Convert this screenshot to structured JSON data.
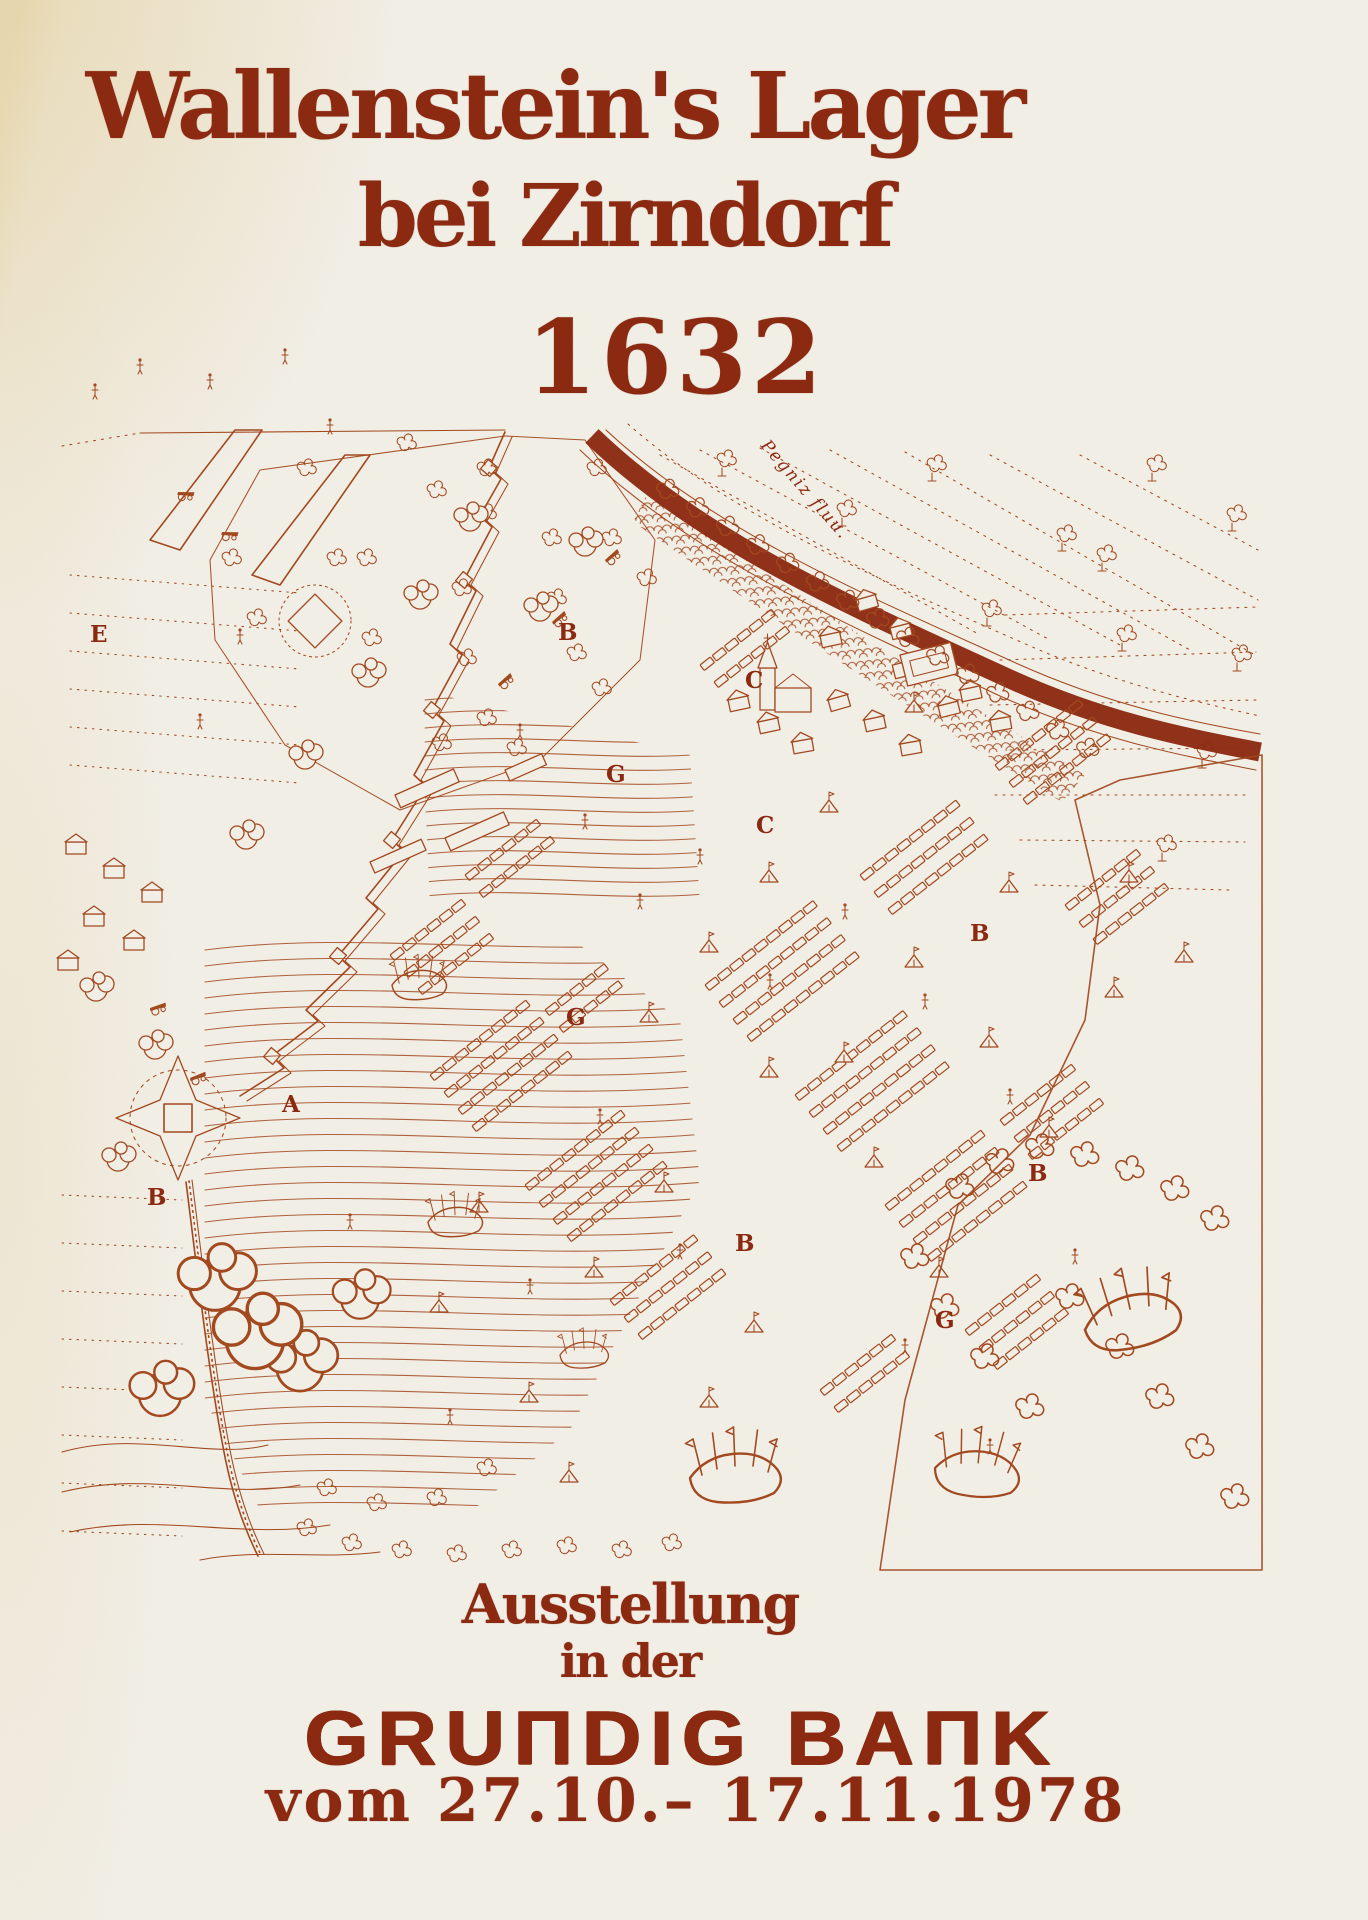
{
  "poster": {
    "title_line1": "Wallenstein's Lager",
    "title_line2": "bei Zirndorf",
    "year": "1632",
    "footer_line1": "Ausstellung",
    "footer_line2": "in der",
    "bank_name": "GRUNDIG BANK",
    "bank_display": "GRUΠDIG BAΠK",
    "date_range": "vom 27.10.– 17.11.1978"
  },
  "map": {
    "river_label": "Pegniz fluu.",
    "letters": [
      {
        "label": "E",
        "x": 90,
        "y": 642
      },
      {
        "label": "B",
        "x": 558,
        "y": 640
      },
      {
        "label": "C",
        "x": 745,
        "y": 688
      },
      {
        "label": "G",
        "x": 606,
        "y": 782
      },
      {
        "label": "C",
        "x": 756,
        "y": 833
      },
      {
        "label": "A",
        "x": 282,
        "y": 1112
      },
      {
        "label": "B",
        "x": 970,
        "y": 941
      },
      {
        "label": "G",
        "x": 566,
        "y": 1025
      },
      {
        "label": "B",
        "x": 1028,
        "y": 1181
      },
      {
        "label": "B",
        "x": 147,
        "y": 1205
      },
      {
        "label": "B",
        "x": 735,
        "y": 1251
      },
      {
        "label": "G",
        "x": 935,
        "y": 1328
      }
    ]
  },
  "colors": {
    "ink": "#a3491f",
    "ink_dark": "#8c2a11",
    "paper": "#f2efe7",
    "corner_tint": "#e4cf9e"
  }
}
